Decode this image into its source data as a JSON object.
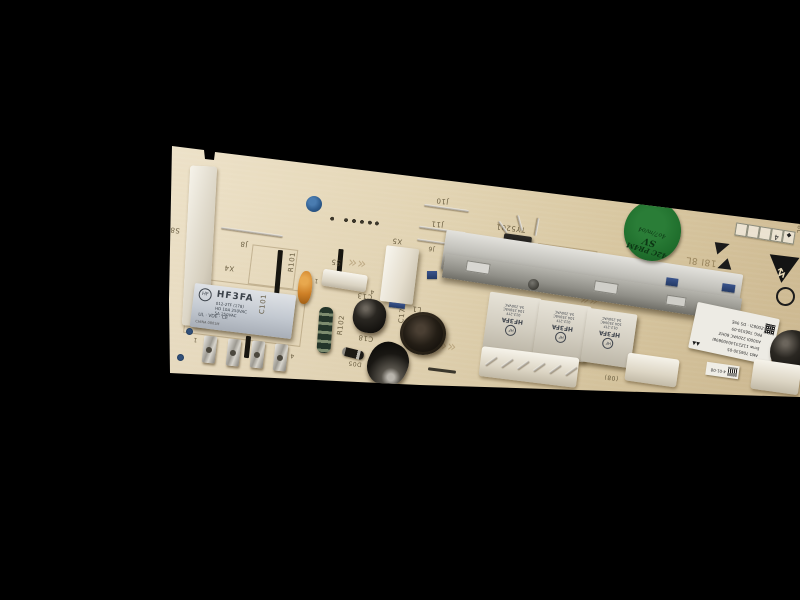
{
  "scene": {
    "background": "#000000",
    "description": "photo of an appliance electronic control PCB lying diagonally, component side up, silkscreen rotated 180°"
  },
  "silkscreen": {
    "s8": "S8",
    "j8": "J8",
    "x4": "X4",
    "c101": "C101",
    "r101": "R101",
    "s5": "S5",
    "num1": "1",
    "num4": "4",
    "r102": "R102",
    "c13": "C13",
    "d05": "D05",
    "c18": "C18",
    "l1": "L1",
    "c17": "C17",
    "x5": "X5",
    "j10": "J10",
    "j11": "J11",
    "j6": "J6",
    "ty5201": "TY5201",
    "j30": "(08)",
    "date_print": "18I 8L",
    "chevron": "««"
  },
  "relay_large": {
    "brand_mark": "HF",
    "model": "HF3FA",
    "line1": "012-2TF (178)",
    "line2": "HD 10A 250VAC",
    "line3": "5A 250VAC",
    "approvals": "UL · VDE · CE",
    "line4": "CHINA 0801M"
  },
  "relay_small": {
    "brand_mark": "HF",
    "model": "HF3FA",
    "line1": "012-2TF",
    "line2": "10A 250VAC",
    "line3": "5A 250VAC"
  },
  "sticker": {
    "bg": "#1f6e2c",
    "line1": "42C PR4M",
    "line2": "SV",
    "line3": "4o7/m/o4"
  },
  "main_label": {
    "line1": "AKO 706530-05",
    "line2": "Emw 11Z23140400698I",
    "line3": "AS000I 220VAC 60HZ",
    "line4": "PRG 706530-09",
    "line5": "Z0082I · DS 99E",
    "triangles": "▲▲"
  },
  "small_label": {
    "text": "4·01·08"
  },
  "stamp_strip": {
    "cells": [
      "",
      "",
      "",
      "4",
      "◆"
    ],
    "side_text": "HW08L"
  },
  "icons": {
    "esd_bolt": "↯"
  }
}
